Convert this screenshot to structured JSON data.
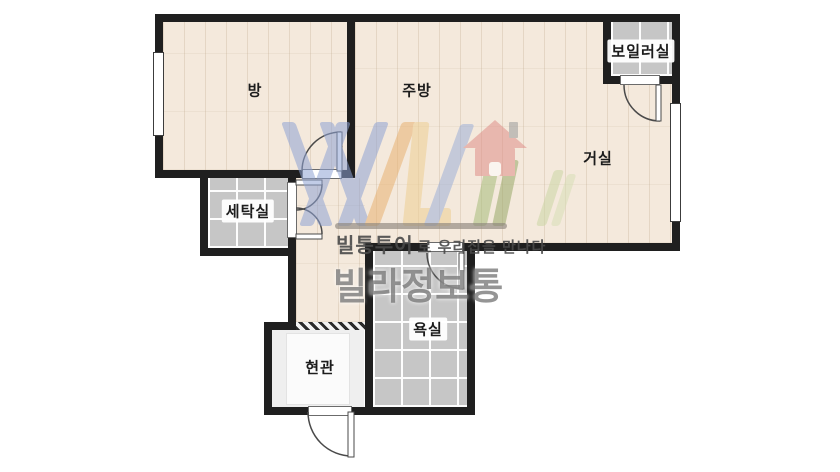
{
  "image_type": "apartment floor plan",
  "rooms": {
    "bang": {
      "label": "방"
    },
    "jubang": {
      "label": "주방"
    },
    "geosil": {
      "label": "거실"
    },
    "boiler": {
      "label": "보일러실"
    },
    "setaksil": {
      "label": "세탁실"
    },
    "yoksil": {
      "label": "욕실"
    },
    "hyeongwan": {
      "label": "현관"
    }
  },
  "watermark": {
    "brand_bold": "빌통투어",
    "tagline_rest": "로 우리집을 만나다",
    "big_text": "빌라정보통"
  },
  "palette": {
    "wall": "#1f1f1f",
    "wood_floor": "#f4e9dc",
    "tile_floor": "#c6c6c6",
    "tile_grout": "#fdfdfd",
    "entrance_floor": "#efefef",
    "watermark_gray": "#6c6c6c",
    "logo_blue": "#8fa3d4",
    "logo_orange": "#e8b272",
    "logo_yellow": "#eecf93",
    "logo_slash_blue": "#9db0d8",
    "logo_green": "#a6bd7b",
    "logo_olive": "#99a968",
    "logo_house_red": "#e09089"
  }
}
